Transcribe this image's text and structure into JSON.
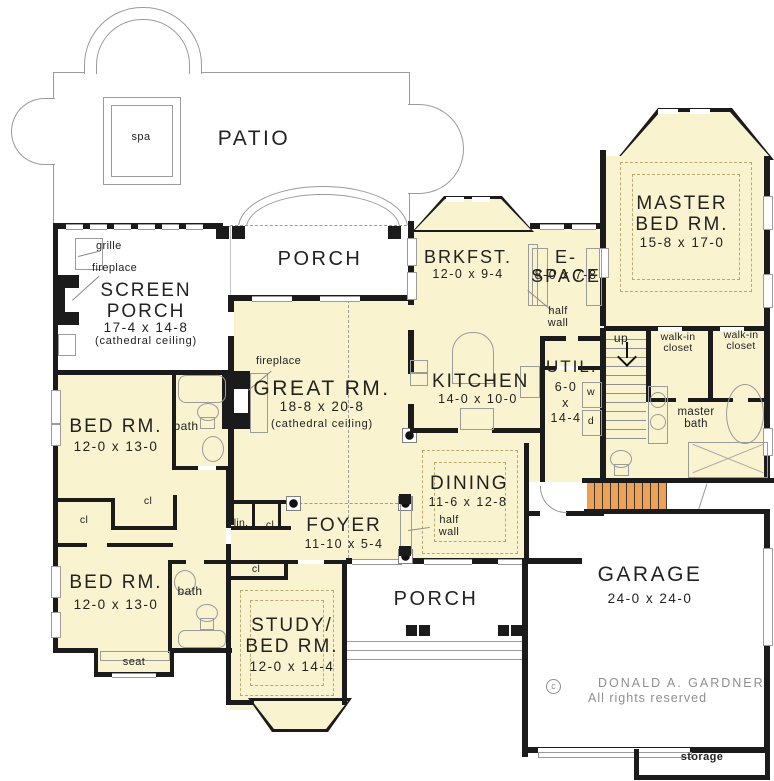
{
  "colors": {
    "fill": "#FAF3CF",
    "wall": "#1b1b1b",
    "outline": "#9b9b9b",
    "stairs": "#F0A053",
    "copyright": "#8f8f8f"
  },
  "rooms": {
    "patio": {
      "label": "PATIO"
    },
    "spa": {
      "label": "spa"
    },
    "porch_upper": {
      "label": "PORCH"
    },
    "porch_lower": {
      "label": "PORCH"
    },
    "screen_porch": {
      "label": "SCREEN\nPORCH",
      "dims": "17-4 x 14-8",
      "note": "(cathedral ceiling)"
    },
    "great_rm": {
      "label": "GREAT RM.",
      "dims": "18-8 x 20-8",
      "note": "(cathedral ceiling)"
    },
    "master_bed": {
      "label": "MASTER\nBED RM.",
      "dims": "15-8 x 17-0"
    },
    "brkfst": {
      "label": "BRKFST.",
      "dims": "12-0 x 9-4"
    },
    "espace": {
      "label": "E-SPACE",
      "dims": "8-0 x 7-8"
    },
    "kitchen": {
      "label": "KITCHEN",
      "dims": "14-0 x 10-0"
    },
    "util": {
      "label": "UTIL.",
      "dims": "6-0\nx\n14-4"
    },
    "dining": {
      "label": "DINING",
      "dims": "11-6 x 12-8"
    },
    "foyer": {
      "label": "FOYER",
      "dims": "11-10 x 5-4"
    },
    "bed_rm_upper": {
      "label": "BED RM.",
      "dims": "12-0 x 13-0"
    },
    "bed_rm_lower": {
      "label": "BED RM.",
      "dims": "12-0 x 13-0"
    },
    "study": {
      "label": "STUDY/\nBED RM.",
      "dims": "12-0 x 14-4"
    },
    "garage": {
      "label": "GARAGE",
      "dims": "24-0 x 24-0"
    },
    "master_bath": {
      "label": "master\nbath"
    },
    "walk_in_closet": {
      "label": "walk-in\ncloset"
    }
  },
  "labels": {
    "grille": "grille",
    "fireplace": "fireplace",
    "half_wall": "half\nwall",
    "up": "up",
    "washer": "w",
    "dryer": "d",
    "bath": "bath",
    "cl": "cl",
    "lin": "lin.",
    "seat": "seat",
    "storage": "storage"
  },
  "copyright": {
    "symbol": "c",
    "line1": "DONALD A. GARDNER",
    "line2": "All rights reserved"
  }
}
